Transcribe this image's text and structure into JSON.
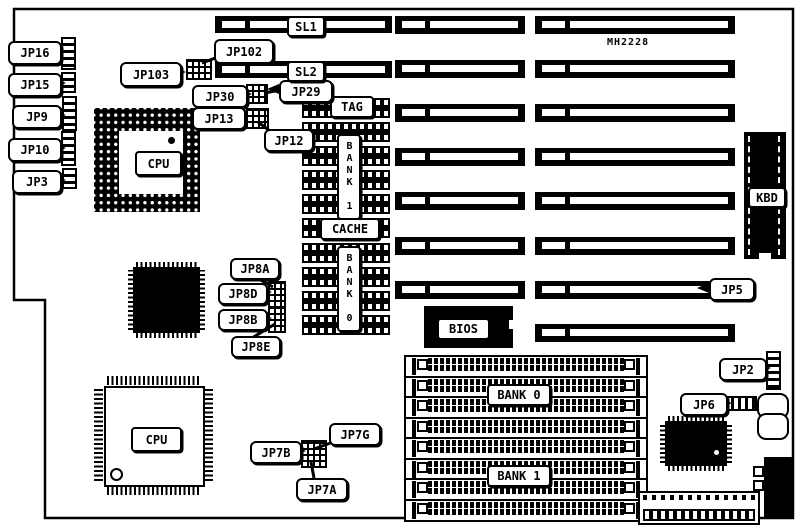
{
  "diagram": {
    "part_number": "MH2228"
  },
  "labels": {
    "jp16": "JP16",
    "jp15": "JP15",
    "jp9": "JP9",
    "jp10": "JP10",
    "jp3": "JP3",
    "jp102": "JP102",
    "jp103": "JP103",
    "jp30": "JP30",
    "jp29": "JP29",
    "jp13": "JP13",
    "jp12": "JP12",
    "jp8a": "JP8A",
    "jp8d": "JP8D",
    "jp8b": "JP8B",
    "jp8e": "JP8E",
    "jp7b": "JP7B",
    "jp7g": "JP7G",
    "jp7a": "JP7A",
    "jp5": "JP5",
    "jp2": "JP2",
    "jp6": "JP6",
    "sl1": "SL1",
    "sl2": "SL2",
    "tag": "TAG",
    "cache": "CACHE",
    "bank1_cache": "BANK 1",
    "bank0_cache": "BANK 0",
    "bank0_simm": "BANK 0",
    "bank1_simm": "BANK 1",
    "bios": "BIOS",
    "kbd": "KBD",
    "cpu_pga": "CPU",
    "cpu_qfp": "CPU"
  },
  "connector": {
    "pins_top": 13,
    "pins_bottom": 14
  },
  "colors": {
    "ink": "#000000",
    "paper": "#ffffff"
  }
}
